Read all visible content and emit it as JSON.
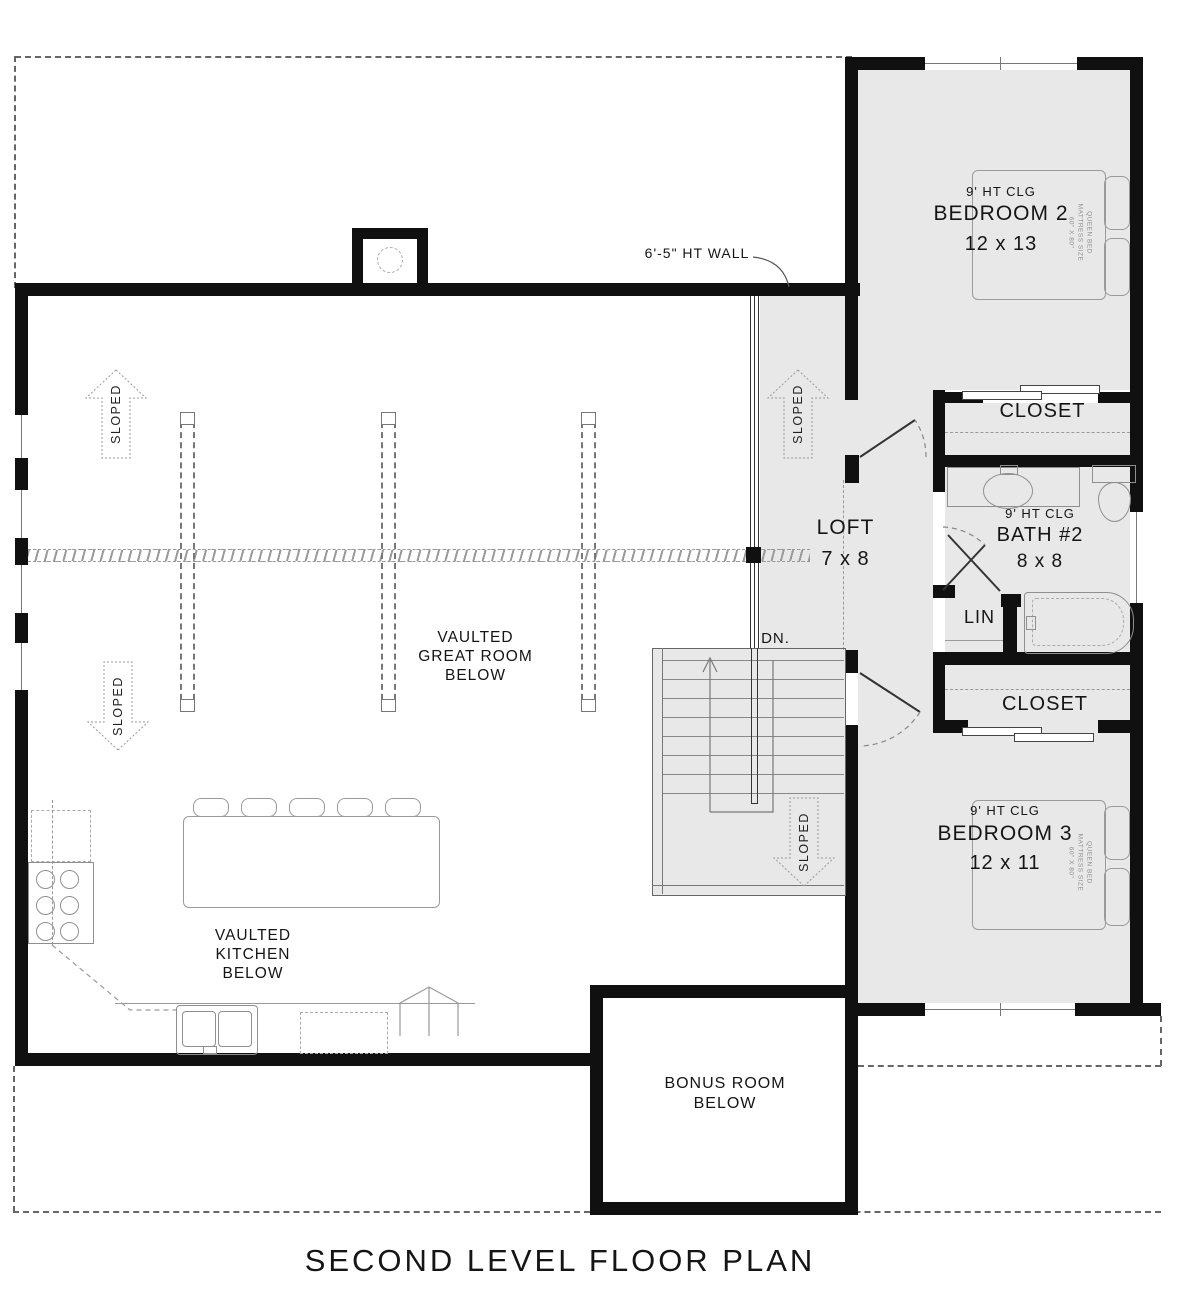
{
  "title": "SECOND LEVEL FLOOR PLAN",
  "colors": {
    "wall": "#101010",
    "room_fill": "#e8e8e8",
    "thin_line": "#8a8a8a"
  },
  "rooms": {
    "bedroom2": {
      "ceiling": "9' HT CLG",
      "name": "BEDROOM 2",
      "dims": "12 x 13"
    },
    "closet_upper": {
      "name": "CLOSET"
    },
    "bath2": {
      "ceiling": "9' HT CLG",
      "name": "BATH #2",
      "dims": "8 x 8"
    },
    "linen": {
      "name": "LIN"
    },
    "closet_lower": {
      "name": "CLOSET"
    },
    "bedroom3": {
      "ceiling": "9' HT CLG",
      "name": "BEDROOM 3",
      "dims": "12 x 11"
    },
    "loft": {
      "name": "LOFT",
      "dims": "7 x 8"
    },
    "great_room": {
      "line1": "VAULTED",
      "line2": "GREAT ROOM",
      "line3": "BELOW"
    },
    "kitchen": {
      "line1": "VAULTED",
      "line2": "KITCHEN",
      "line3": "BELOW"
    },
    "bonus_room": {
      "line1": "BONUS ROOM",
      "line2": "BELOW"
    }
  },
  "annotations": {
    "wall_height": "6'-5\" HT WALL",
    "down": "DN.",
    "sloped": "SLOPED",
    "bed_label": {
      "line1": "QUEEN BED",
      "line2": "MATTRESS SIZE",
      "line3": "60\" X 80\""
    }
  }
}
